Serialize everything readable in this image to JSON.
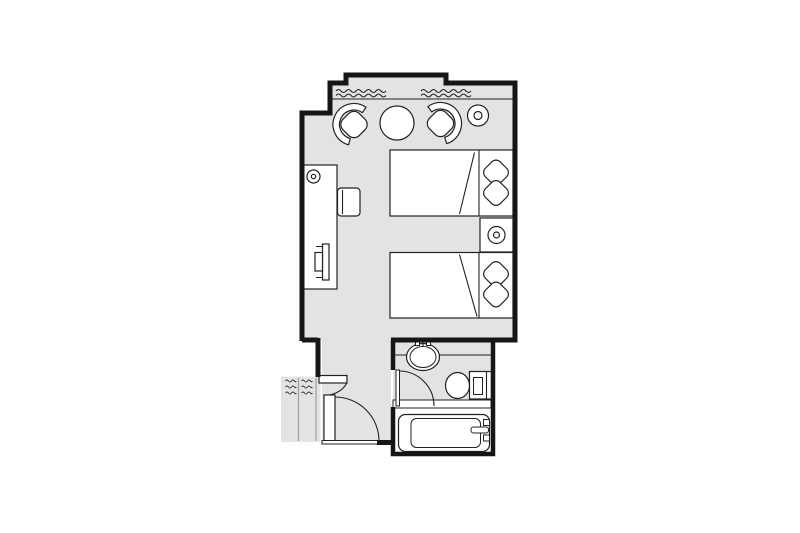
{
  "palette": {
    "background": "#ffffff",
    "floor": "#e3e3e3",
    "wall": "#161616",
    "line": "#222222",
    "furniture_fill": "#ffffff",
    "closet_divider": "#9e9e9e"
  },
  "plan": {
    "label": "hotel-guestroom-floor-plan",
    "window_symbols": 2,
    "rooms": [
      {
        "name": "bedroom",
        "furniture": [
          "armchair-left",
          "armchair-right",
          "round-table",
          "floor-lamp",
          "twin-bed-upper",
          "twin-bed-lower",
          "pillows",
          "nightstand",
          "nightstand-lamp",
          "desk",
          "desk-lamp",
          "desk-chair",
          "tv"
        ]
      },
      {
        "name": "entry-hall",
        "furniture": [
          "entry-door",
          "closet-door",
          "threshold"
        ]
      },
      {
        "name": "closet",
        "furniture": [
          "hanging-rail-left",
          "hanging-rail-right"
        ]
      },
      {
        "name": "bathroom",
        "furniture": [
          "bathroom-door",
          "vanity-sink",
          "toilet",
          "bathtub",
          "tub-faucet"
        ]
      }
    ]
  }
}
